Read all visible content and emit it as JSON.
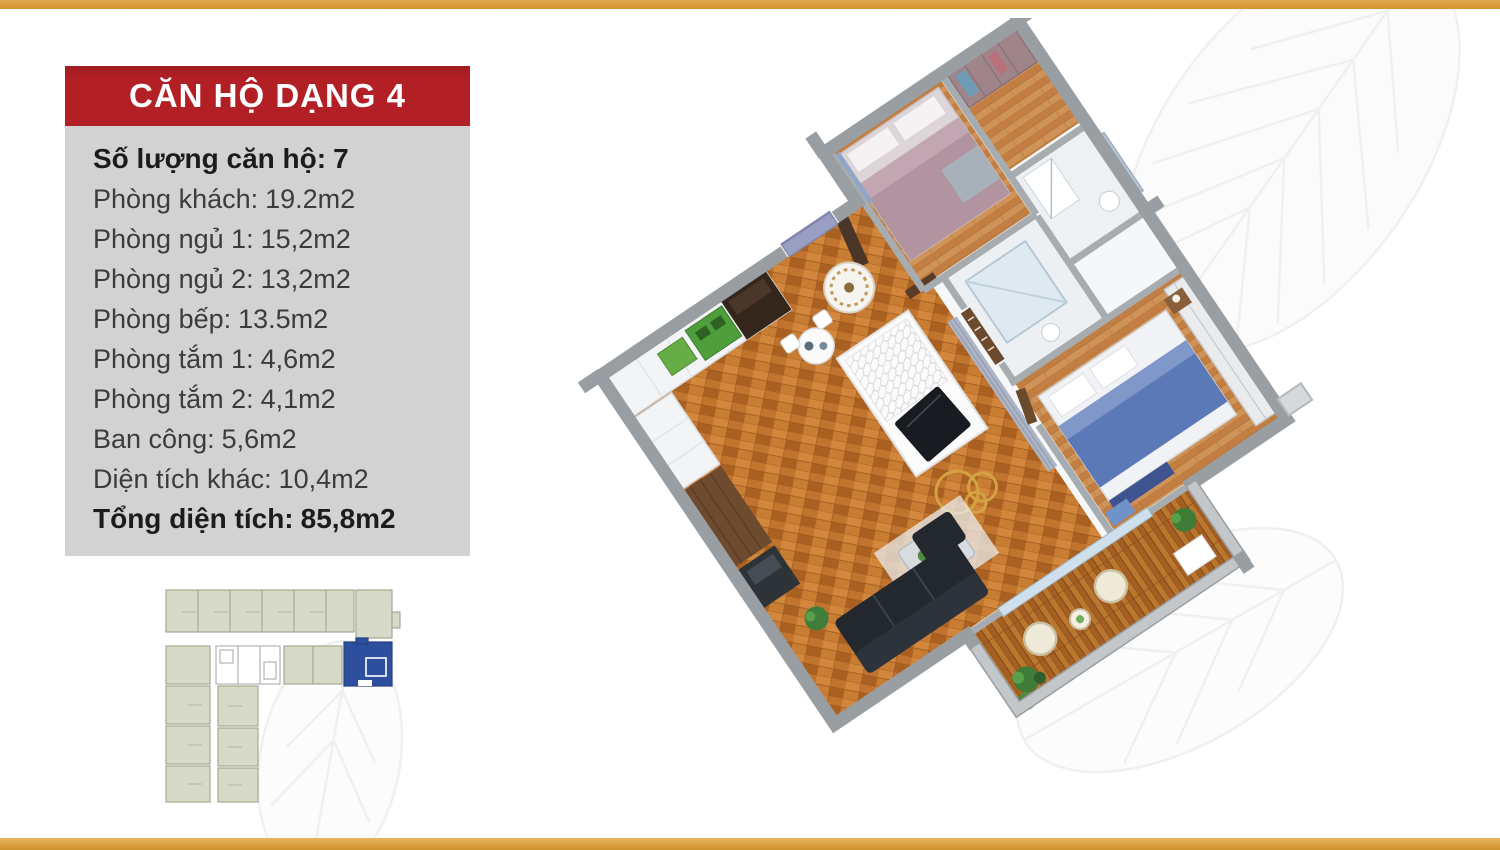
{
  "page": {
    "background_color": "#ffffff",
    "top_bar_color": "#d89b3b",
    "bottom_bar_color": "#d89b3b"
  },
  "panel": {
    "title": "CĂN HỘ DẠNG 4",
    "title_bg_color": "#b22026",
    "title_text_color": "#ffffff",
    "box_bg_color": "#d2d2d2",
    "specs": [
      {
        "label": "Số lượng căn hộ:",
        "value": "7"
      },
      {
        "label": "Phòng khách:",
        "value": "19.2m2"
      },
      {
        "label": "Phòng ngủ 1:",
        "value": "15,2m2"
      },
      {
        "label": "Phòng ngủ 2:",
        "value": "13,2m2"
      },
      {
        "label": "Phòng bếp:",
        "value": "13.5m2"
      },
      {
        "label": "Phòng tắm 1:",
        "value": "4,6m2"
      },
      {
        "label": "Phòng tắm 2:",
        "value": "4,1m2"
      },
      {
        "label": "Ban công:",
        "value": "5,6m2"
      },
      {
        "label": "Diện tích khác:",
        "value": "10,4m2"
      },
      {
        "label": "Tổng diện tích:",
        "value": "85,8m2"
      }
    ]
  },
  "location_map": {
    "unit_fill_color": "#d8dac9",
    "unit_stroke_color": "#a4aa92",
    "core_fill_color": "#ffffff",
    "highlighted_unit_color": "#2e4f9e"
  },
  "render_colors": {
    "wall_gray": "#989ea2",
    "wood_living": "#c0742e",
    "wood_bedroom": "#cf9257",
    "wood_balcony": "#a65f22",
    "bed2_blanket_blue": "#5b79b6",
    "gold_rings": "#d4a242"
  }
}
